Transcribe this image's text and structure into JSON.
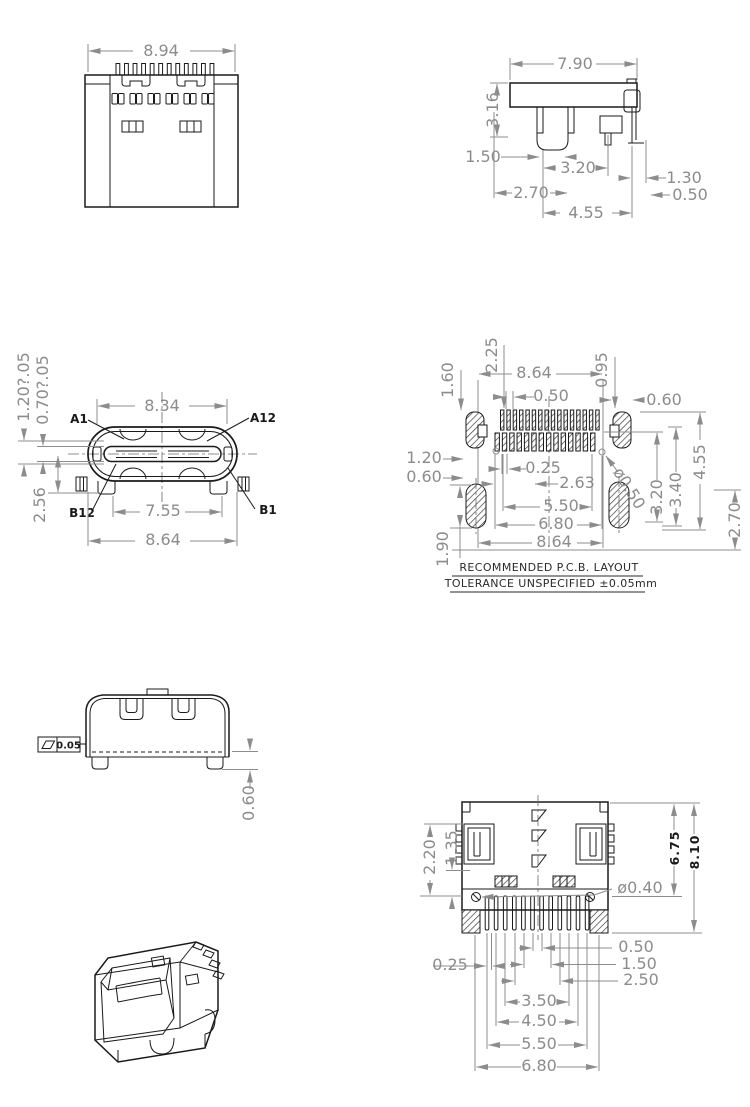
{
  "colors": {
    "edge": "#1a1a1a",
    "dimension": "#8c8c8c",
    "note": "#2a2a2a",
    "background": "#ffffff"
  },
  "front_view": {
    "dim_width": "8.94"
  },
  "side_view": {
    "dim_width": "7.90",
    "dim_height": "3.16",
    "dim_150": "1.50",
    "dim_320": "3.20",
    "dim_130": "1.30",
    "dim_270": "2.70",
    "dim_050": "0.50",
    "dim_455": "4.55"
  },
  "face_view": {
    "dim_834": "8.34",
    "dim_755": "7.55",
    "dim_864": "8.64",
    "dim_256": "2.56",
    "dim_tongue1": "1.20?.05",
    "dim_tongue2": "0.70?.05",
    "label_a1": "A1",
    "label_a12": "A12",
    "label_b12": "B12",
    "label_b1": "B1"
  },
  "pcb_view": {
    "dim_225": "2.25",
    "dim_160": "1.60",
    "dim_095": "0.95",
    "dim_864_top": "8.64",
    "dim_050": "0.50",
    "dim_060_right": "0.60",
    "dim_120": "1.20",
    "dim_060_left": "0.60",
    "dim_025": "0.25",
    "dim_263": "2.63",
    "dim_550": "5.50",
    "dim_680": "6.80",
    "dim_864_bottom": "8.64",
    "dim_190": "1.90",
    "dim_320": "3.20",
    "dim_340": "3.40",
    "dim_455": "4.55",
    "dim_270": "2.70",
    "dim_hole": "ø0.50",
    "note_line1": "RECOMMENDED  P.C.B.  LAYOUT",
    "note_line2": "TOLERANCE  UNSPECIFIED  ±0.05mm"
  },
  "rear_view": {
    "flatness_value": "0.05",
    "dim_060": "0.60"
  },
  "bottom_view": {
    "dim_220": "2.20",
    "dim_135": "1.35",
    "dim_675": "6.75",
    "dim_810": "8.10",
    "dim_hole": "ø0.40",
    "dim_050": "0.50",
    "dim_150": "1.50",
    "dim_250": "2.50",
    "dim_025": "0.25",
    "dim_350": "3.50",
    "dim_450": "4.50",
    "dim_550": "5.50",
    "dim_680": "6.80"
  }
}
